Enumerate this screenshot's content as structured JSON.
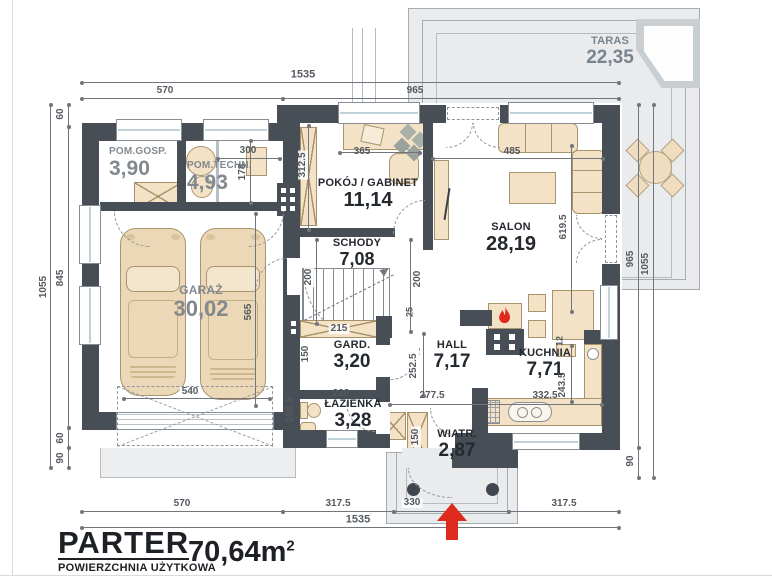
{
  "title": {
    "floor": "PARTER",
    "area_label": "POWIERZCHNIA UŻYTKOWA",
    "area_value": "70,64m",
    "area_sup": "2"
  },
  "rooms": {
    "pom_gosp": {
      "name": "POM.GOSP.",
      "area": "3,90"
    },
    "pom_techn": {
      "name": "POM.TECHN.",
      "area": "4,93"
    },
    "garaz": {
      "name": "GARAŻ",
      "area": "30,02"
    },
    "pokoj": {
      "name": "POKÓJ / GABINET",
      "area": "11,14"
    },
    "schody": {
      "name": "SCHODY",
      "area": "7,08"
    },
    "salon": {
      "name": "SALON",
      "area": "28,19"
    },
    "gard": {
      "name": "GARD.",
      "area": "3,20"
    },
    "hall": {
      "name": "HALL",
      "area": "7,17"
    },
    "kuchnia": {
      "name": "KUCHNIA",
      "area": "7,71"
    },
    "lazienka": {
      "name": "ŁAZIENKA",
      "area": "3,28"
    },
    "wiatr": {
      "name": "WIATR.",
      "area": "2,87"
    },
    "taras": {
      "name": "TARAS",
      "area": "22,35"
    }
  },
  "dims": {
    "top": [
      "1535",
      "570",
      "965"
    ],
    "bottom": [
      "570",
      "317.5",
      "330",
      "317.5",
      "1535"
    ],
    "left": [
      "1055",
      "60",
      "845",
      "60",
      "90"
    ],
    "right": [
      "965",
      "1055",
      "90"
    ],
    "inner": {
      "i365": "365",
      "i3125": "312.5",
      "i300": "300",
      "i178": "178",
      "i485": "485",
      "i6195": "619.5",
      "i200l": "200",
      "i200r": "200",
      "i25": "25",
      "i215": "215",
      "i150g": "150",
      "i565": "565",
      "i540": "540",
      "i2525": "252.5",
      "i2775": "277.5",
      "i3325": "332.5",
      "i2435": "243.5",
      "i12": "12",
      "i228": "228",
      "i1505": "150.5",
      "i150w": "150"
    }
  },
  "colors": {
    "wall": "#474e55",
    "furniture": "#f3e2c6",
    "terrace": "#e9ebed",
    "accent_red": "#de2a1c",
    "dim_text": "#545a60",
    "label_dark": "#24292f",
    "label_gray": "#83898e",
    "label_taras": "#79848d"
  }
}
